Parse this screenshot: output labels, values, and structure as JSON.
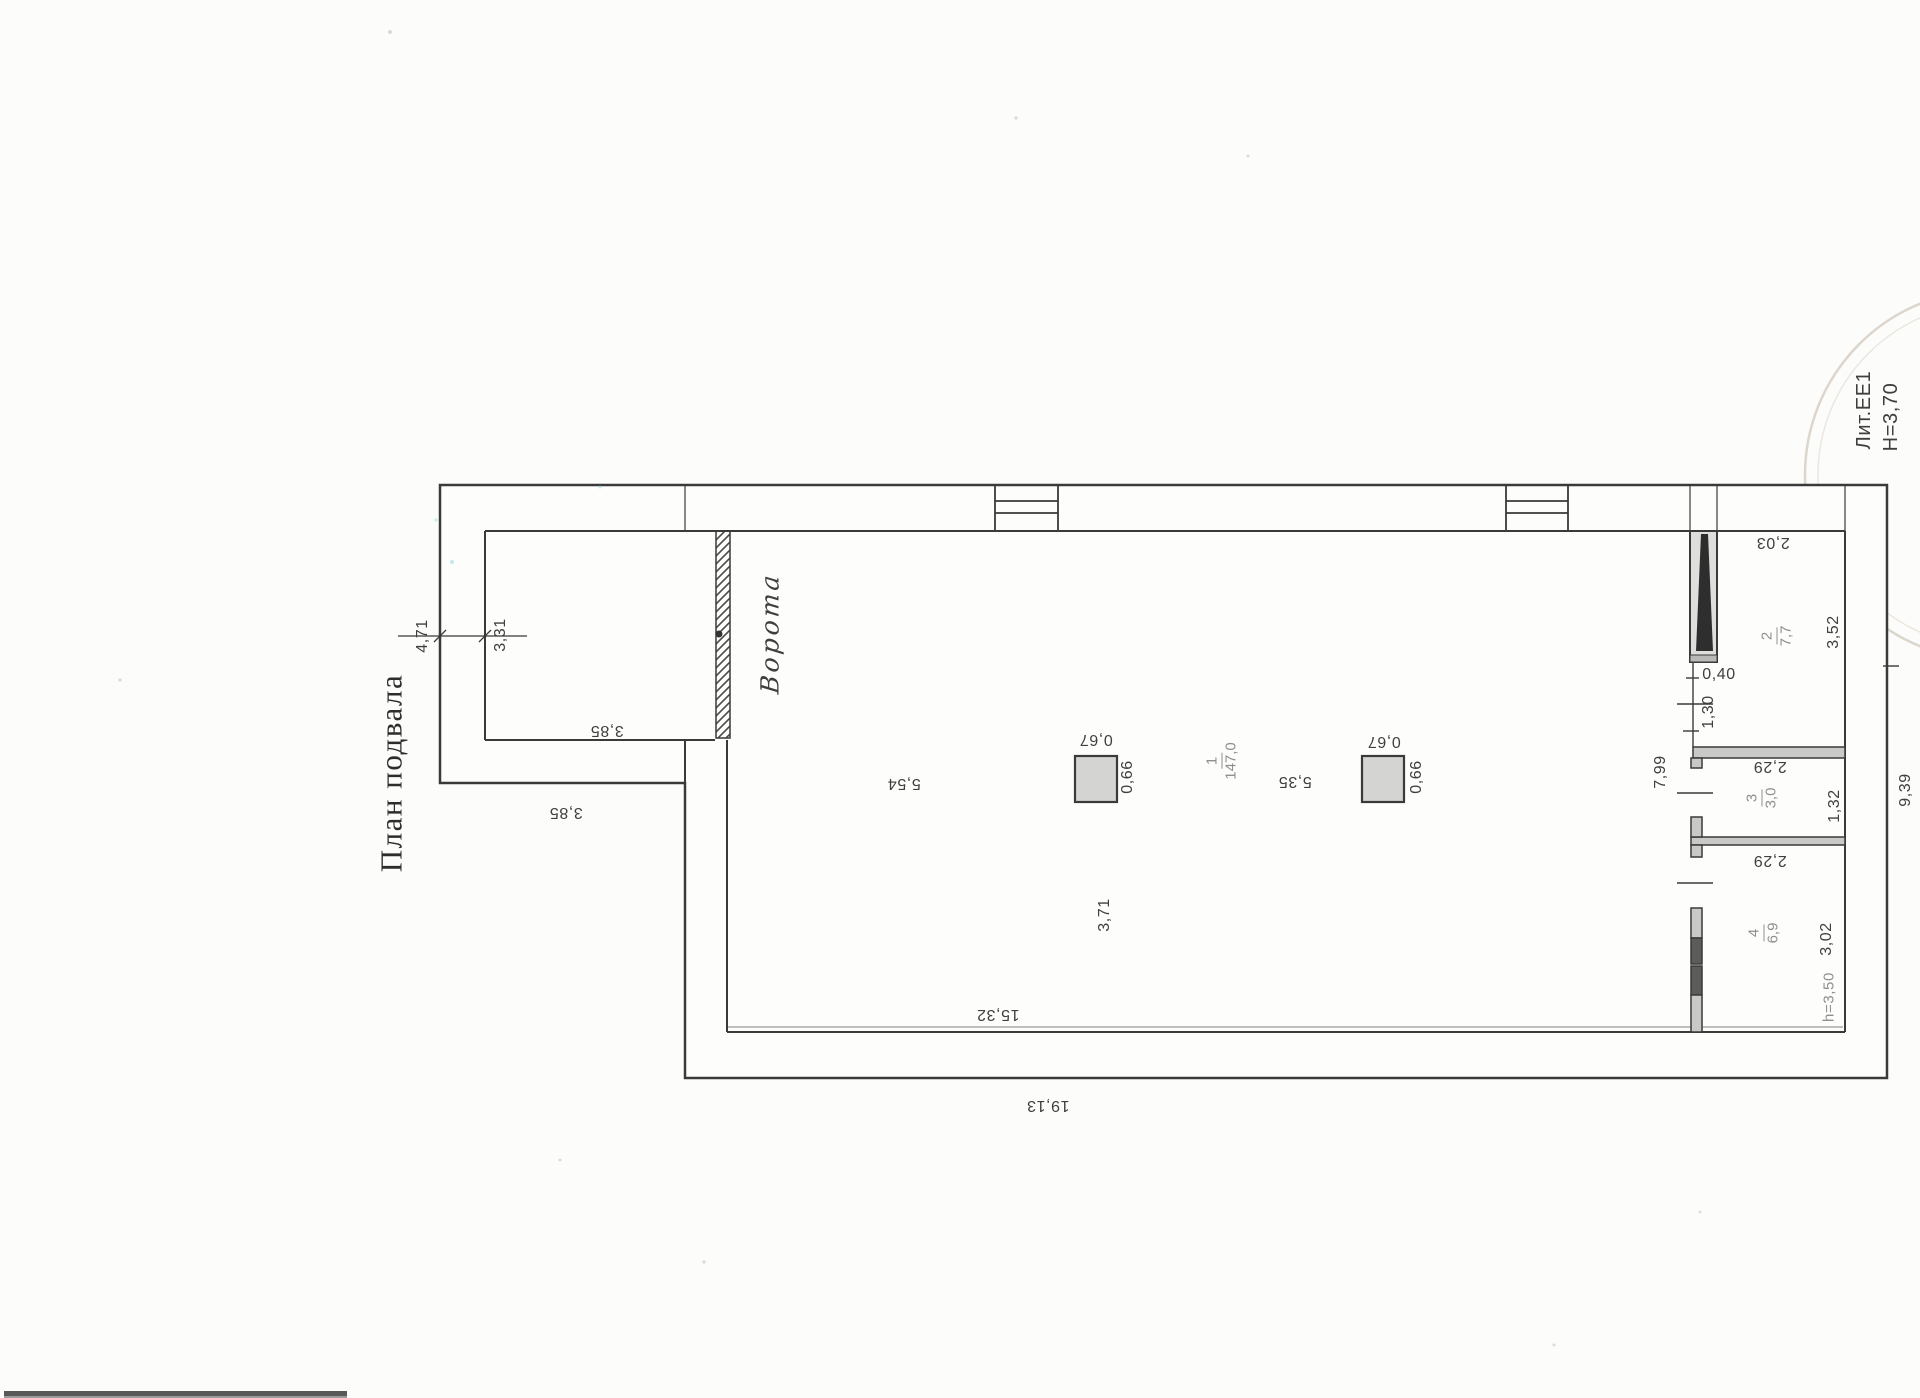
{
  "title": "План подвала",
  "stamp": {
    "liter": "Лит.ЕЕ1",
    "height_note": "Н=3,70"
  },
  "gate_label": "Ворота",
  "rooms": [
    {
      "number": "1",
      "area": "147,0"
    },
    {
      "number": "2",
      "area": "7,7"
    },
    {
      "number": "3",
      "area": "3,0"
    },
    {
      "number": "4",
      "area": "6,9"
    }
  ],
  "dimensions": {
    "ext_outer_width": "4,71",
    "ext_inner_width": "3,31",
    "ext_depth_inner": "3,85",
    "ext_depth_outer": "3,85",
    "hall_gate_to_col": "5,54",
    "col_left_top": "0,67",
    "col_left_side": "0,66",
    "hall_col_to_col": "5,35",
    "col_right_top": "0,67",
    "col_right_side": "0,66",
    "hall_col_offset": "3,71",
    "hall_inner_length": "15,32",
    "building_length": "19,13",
    "stair_width": "0,40",
    "room2_door": "1,30",
    "corridor_length": "7,99",
    "room2_width": "2,03",
    "room2_depth": "3,52",
    "room3_width": "2,29",
    "room3_depth": "1,32",
    "room4_width": "2,29",
    "room4_depth": "3,02",
    "room4_ceiling": "h=3,50",
    "building_side": "9,39"
  },
  "colors": {
    "line": "#3a3a3a",
    "paper": "#fcfcfb",
    "wall_gray": "#c9c9c7",
    "dark_wall": "#5c5c5c",
    "stair_black": "#2e2e2e",
    "column_fill": "#d4d4d2",
    "label_gray": "#8f8f8f",
    "stamp_arc": "#d8d2c6"
  }
}
